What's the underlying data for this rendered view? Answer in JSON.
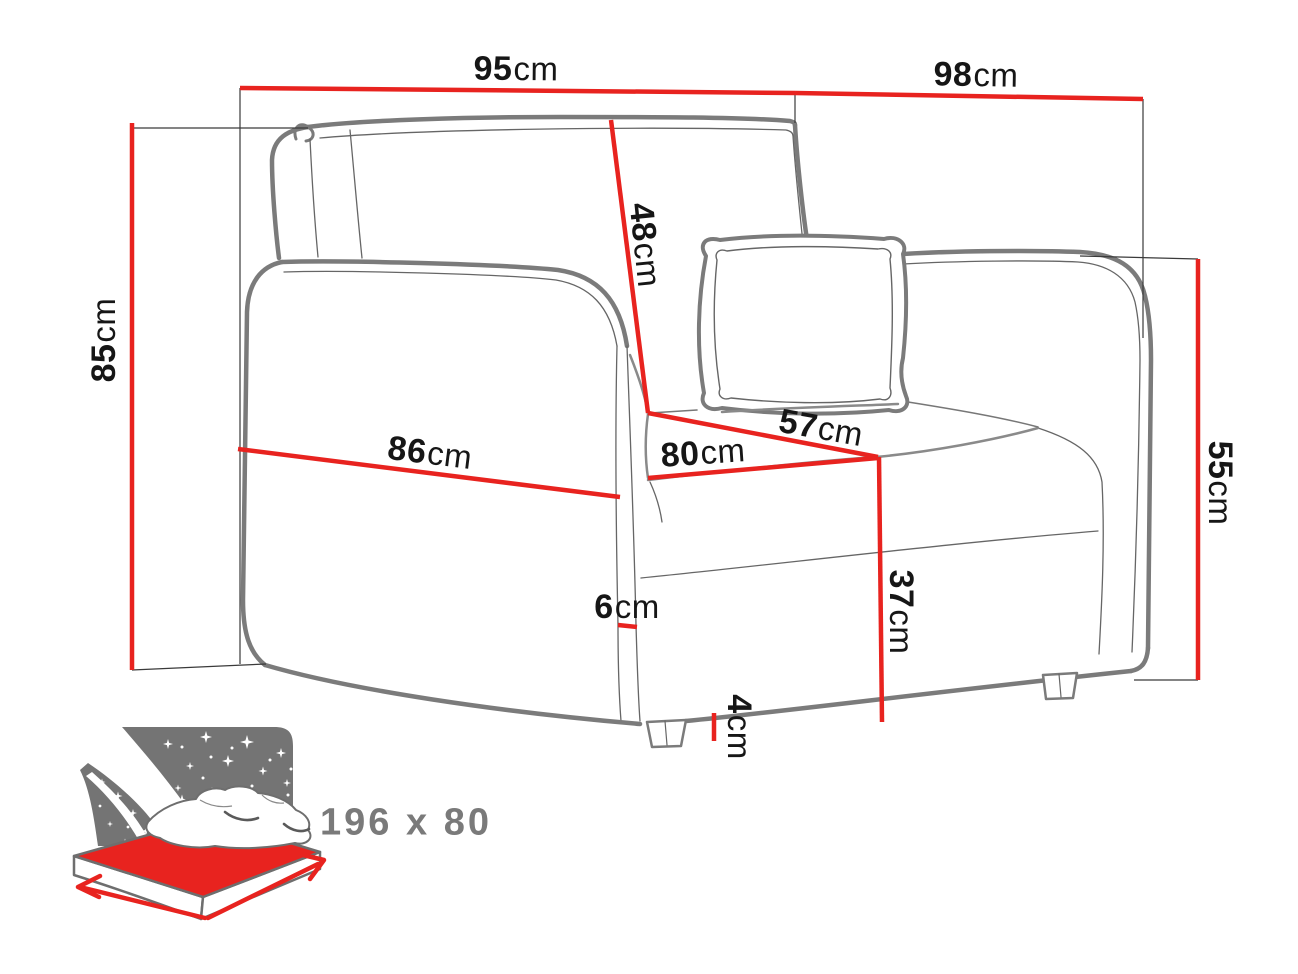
{
  "diagram": {
    "type": "furniture-dimension-diagram",
    "subject": "sofa-bed armchair line drawing with dimension callouts"
  },
  "colors": {
    "dimension_red": "#e8231f",
    "outline_gray": "#7b7b7b",
    "thin_line_gray": "#555555",
    "extension_line": "#3a3a3a",
    "panel_gray": "#747474",
    "label_text": "#161616",
    "bed_text_gray": "#7a7a7a",
    "background": "#ffffff"
  },
  "dimensions": {
    "top_width": {
      "value": "95",
      "unit": "cm"
    },
    "top_depth": {
      "value": "98",
      "unit": "cm"
    },
    "overall_height": {
      "value": "85",
      "unit": "cm"
    },
    "backrest": {
      "value": "48",
      "unit": "cm"
    },
    "seat_depth": {
      "value": "57",
      "unit": "cm"
    },
    "seat_width": {
      "value": "80",
      "unit": "cm"
    },
    "front_width": {
      "value": "86",
      "unit": "cm"
    },
    "armrest_height": {
      "value": "55",
      "unit": "cm"
    },
    "seat_height": {
      "value": "37",
      "unit": "cm"
    },
    "side_rail": {
      "value": "6",
      "unit": "cm"
    },
    "leg_height": {
      "value": "4",
      "unit": "cm"
    }
  },
  "sleeping_area": {
    "label": "196 x 80"
  }
}
